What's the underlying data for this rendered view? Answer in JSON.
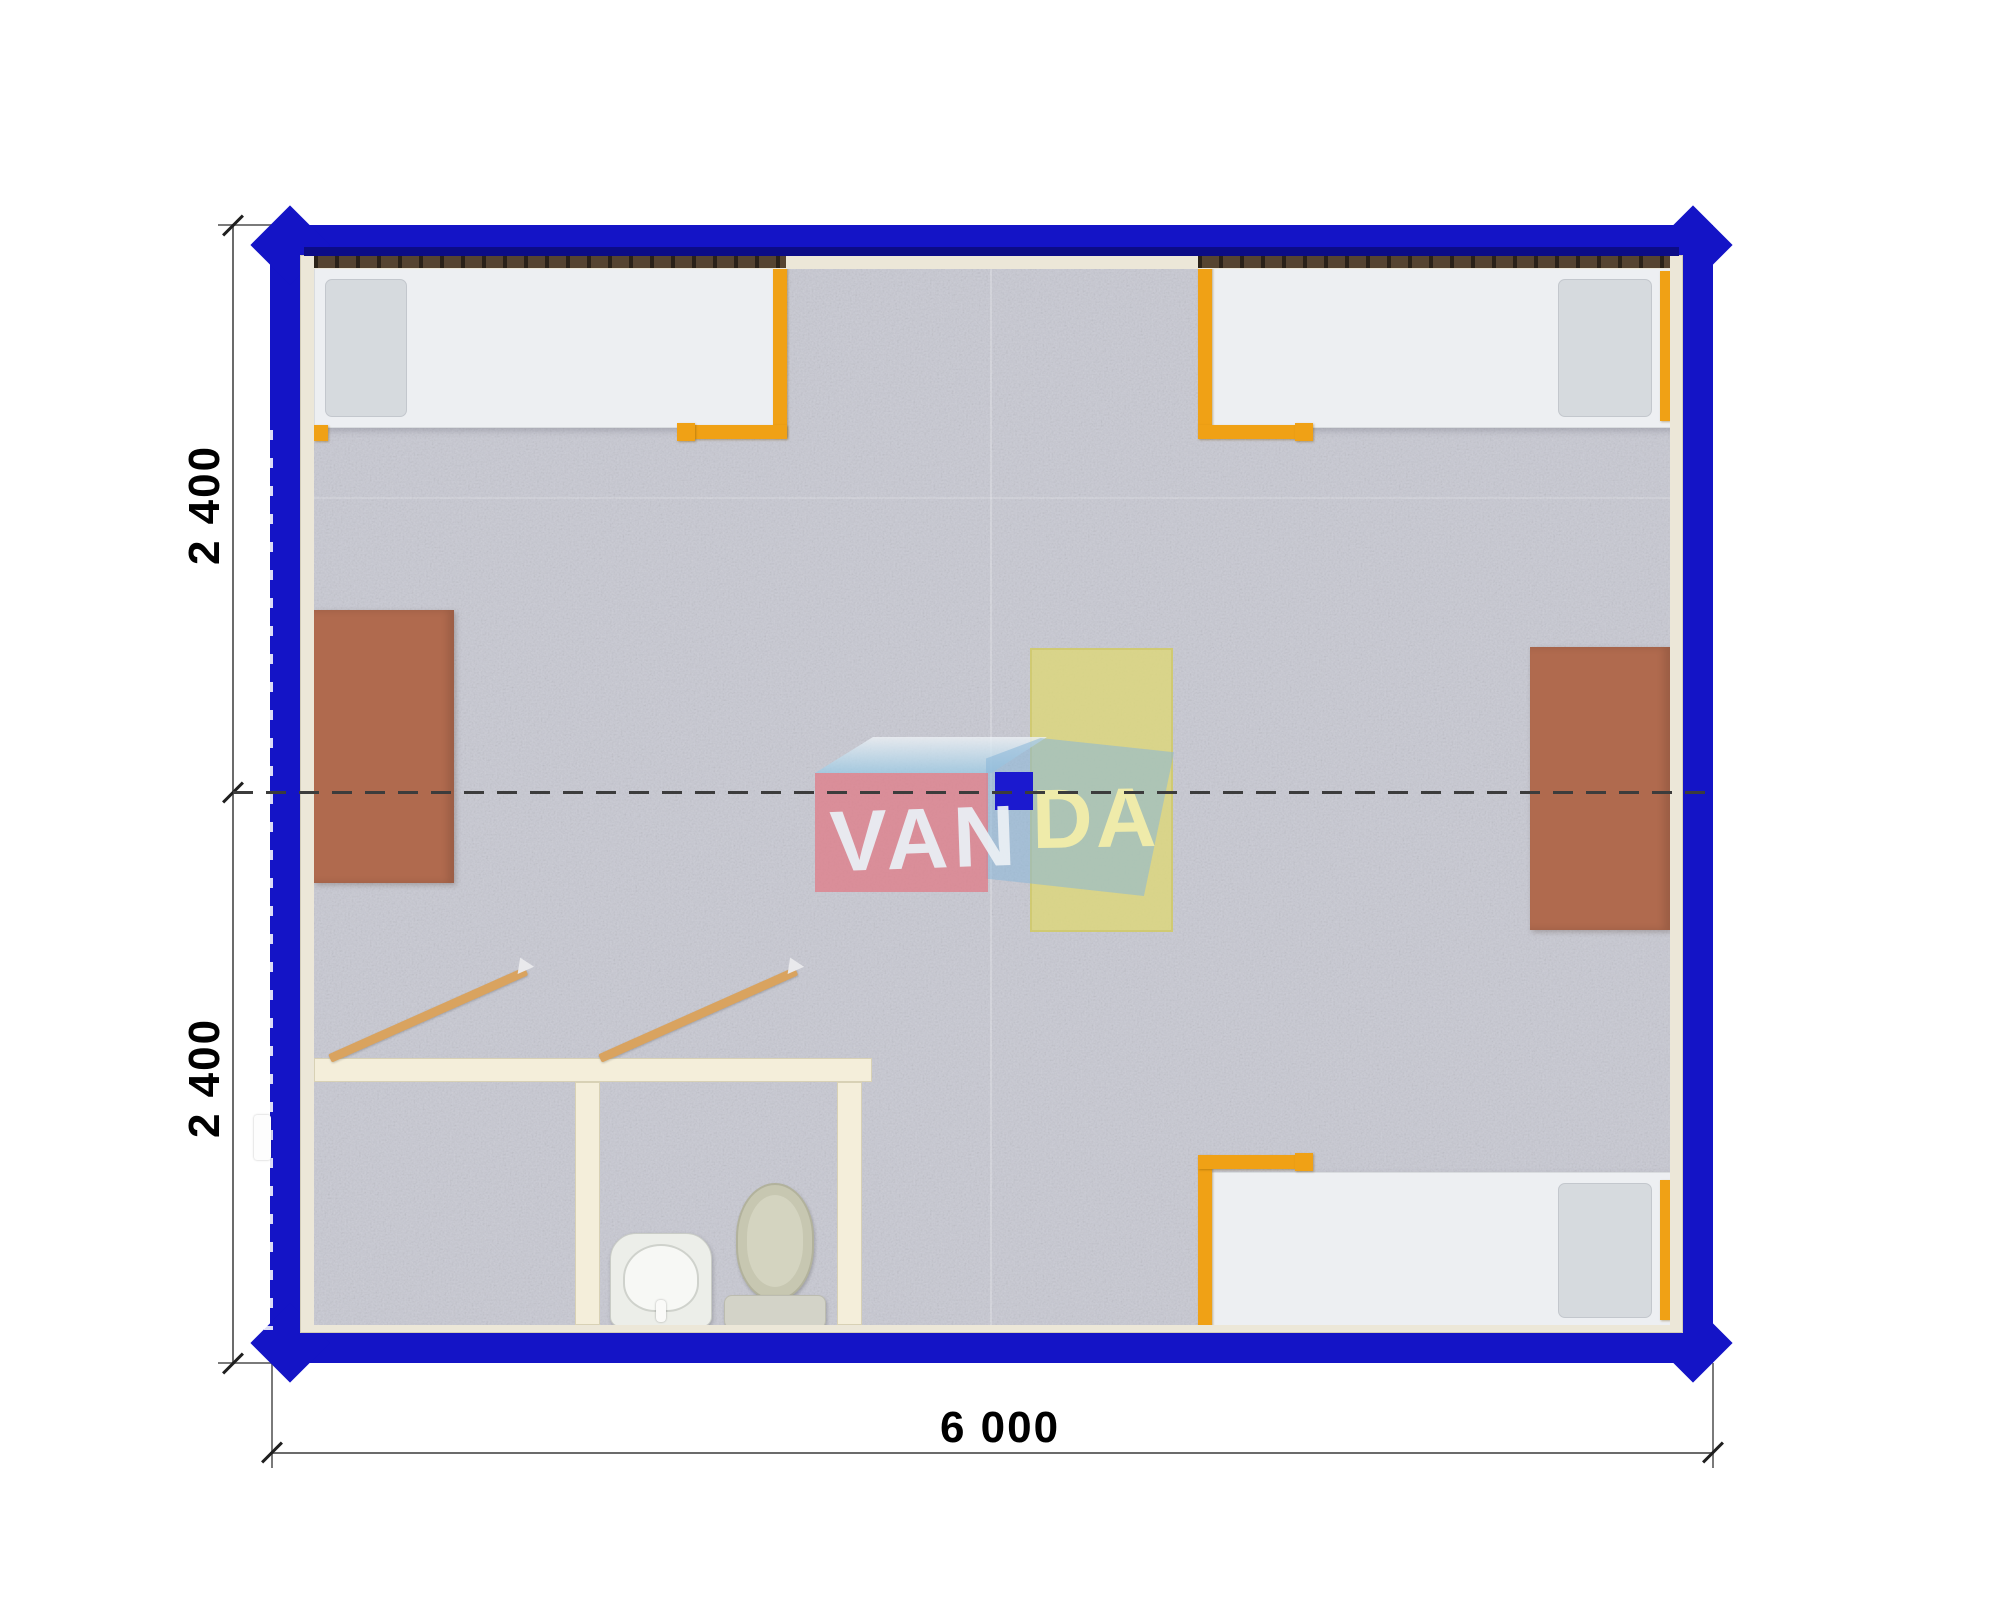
{
  "drawing": {
    "type": "container-cabin-floor-plan",
    "dimensions": {
      "width_label": "6 000",
      "height_top_label": "2 400",
      "height_bottom_label": "2 400"
    },
    "watermark": {
      "brand_left": "VAN",
      "brand_right": "DA"
    },
    "colors": {
      "frame_blue": "#1414c6",
      "inner_navy": "#0c0c86",
      "lining_cream": "#ece7d8",
      "floor_gray": "#c8c9d3",
      "bed_white": "#edeff2",
      "rail_orange": "#f0a115",
      "desk_brown": "#b06a4e",
      "highlight_yellow_table": "#ddd77a",
      "bathroom_wall": "#f4eeda",
      "door_wood": "#d9a35f",
      "watermark_pink": "#df7c88",
      "watermark_blue": "#89b6d8",
      "watermark_square": "#1b19cf"
    },
    "furniture": {
      "beds": [
        "bed-top-left",
        "bed-top-right",
        "bed-bottom-right"
      ],
      "desks": [
        "desk-left-wall",
        "desk-right-wall"
      ],
      "center_table": "highlighted-table",
      "bathroom": [
        "shower-room",
        "wc-room",
        "washbasin",
        "toilet"
      ],
      "doors": [
        "shower-room-door",
        "wc-room-door",
        "side-entry-marker"
      ]
    }
  }
}
